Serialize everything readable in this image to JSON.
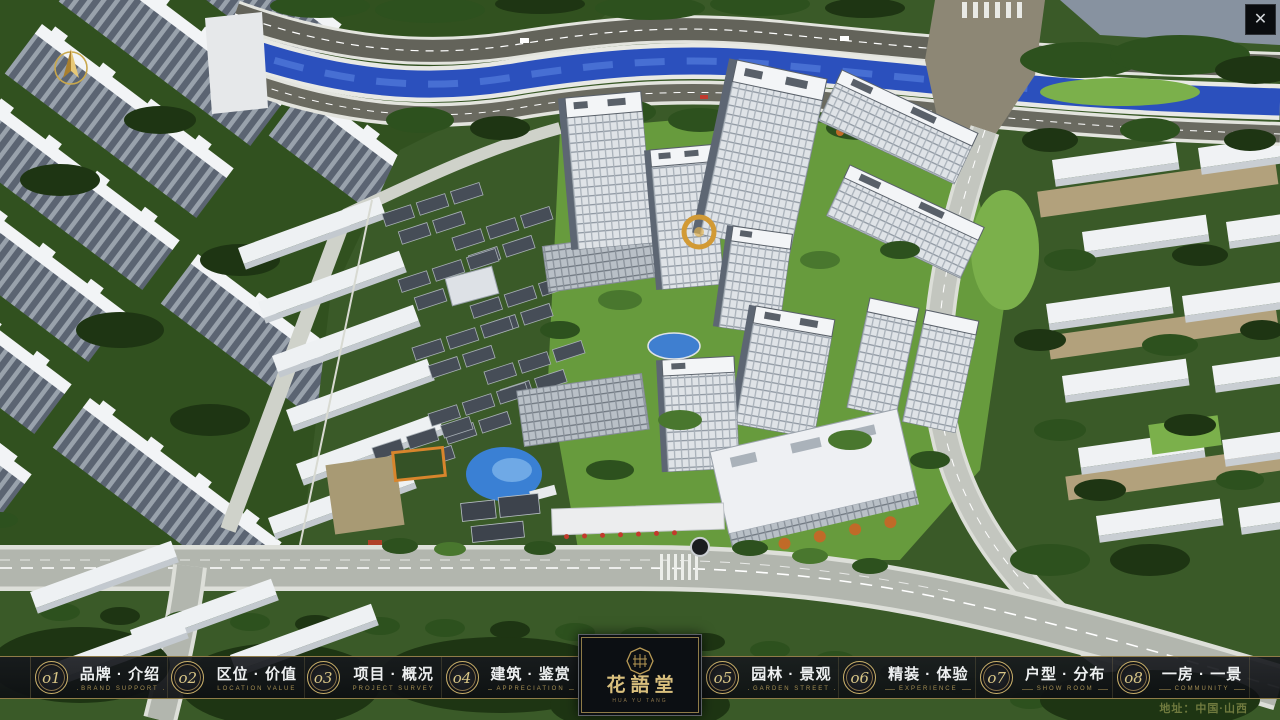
{
  "nav": {
    "items": [
      {
        "num": "o1",
        "zh": "品牌 · 介绍",
        "en": "BRAND SUPPORT"
      },
      {
        "num": "o2",
        "zh": "区位 · 价值",
        "en": "LOCATION VALUE"
      },
      {
        "num": "o3",
        "zh": "项目 · 概况",
        "en": "PROJECT SURVEY"
      },
      {
        "num": "o4",
        "zh": "建筑 · 鉴赏",
        "en": "APPRECIATION"
      },
      {
        "num": "o5",
        "zh": "园林 · 景观",
        "en": "GARDEN STREET"
      },
      {
        "num": "o6",
        "zh": "精装 · 体验",
        "en": "EXPERIENCE"
      },
      {
        "num": "o7",
        "zh": "户型 · 分布",
        "en": "SHOW ROOM"
      },
      {
        "num": "o8",
        "zh": "一房 · 一景",
        "en": "COMMUNITY"
      }
    ]
  },
  "logo": {
    "title": "花語堂",
    "subtitle": "HUA YU TANG"
  },
  "footer": {
    "address": "地址：中国·山西"
  },
  "icons": {
    "close": "✕",
    "compass": "north-arrow"
  },
  "theme": {
    "gold": "#c9b06a",
    "nav_text": "#eef0f1",
    "nav_en": "#a58e52",
    "bar_background": "#14161a",
    "river_blue": "#2b50bd",
    "address_green": "#6f7a3e"
  }
}
